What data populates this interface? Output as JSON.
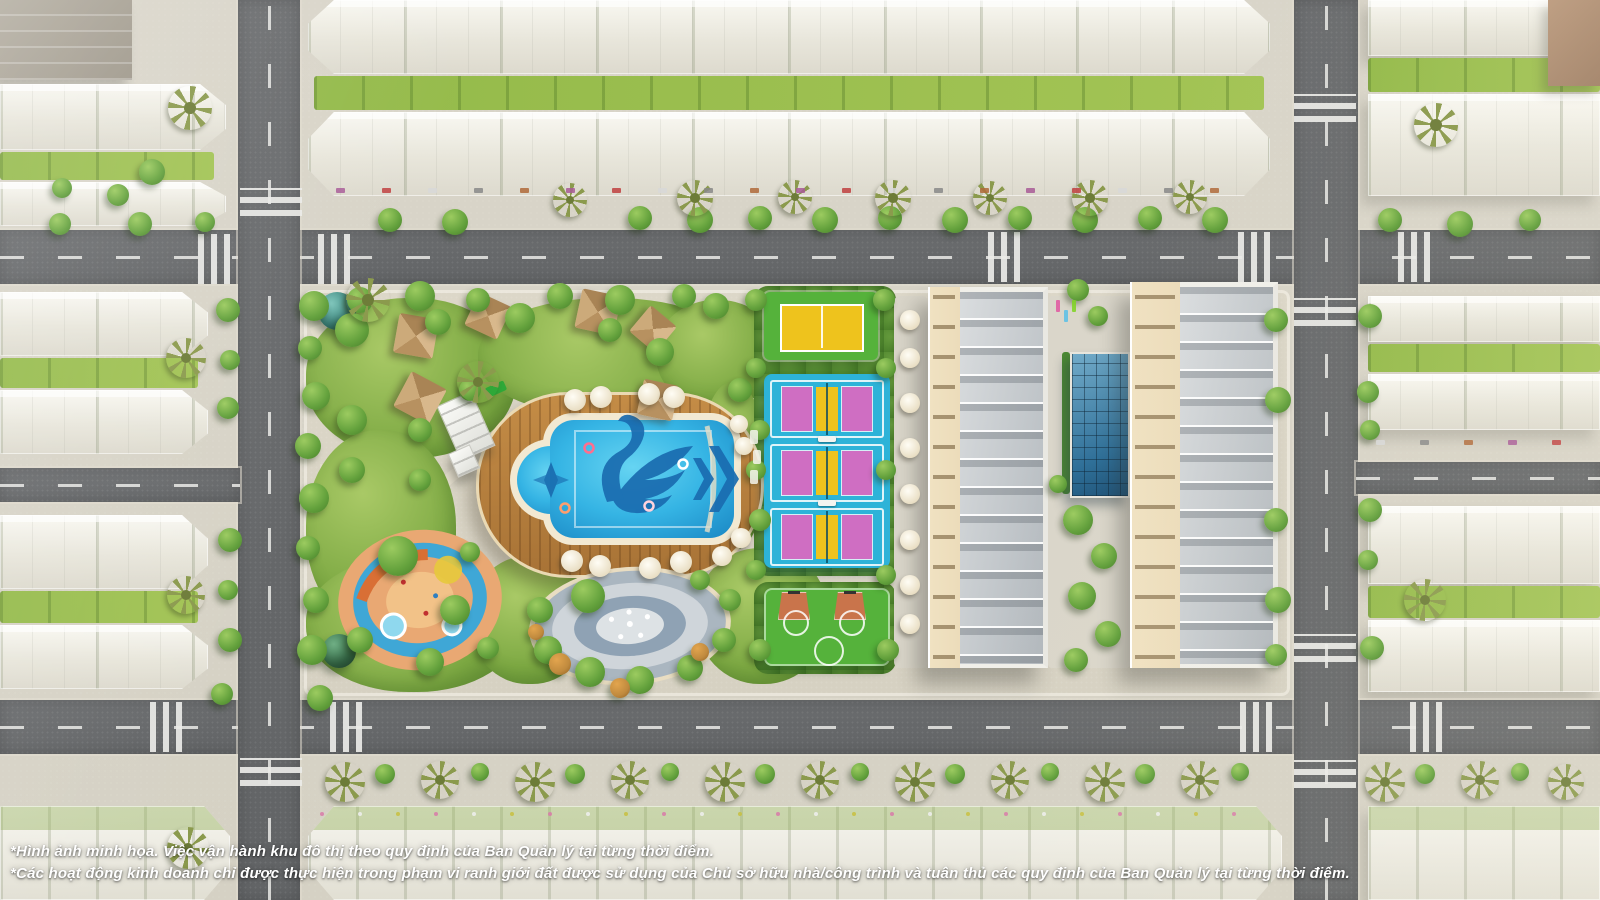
{
  "image": {
    "kind": "aerial-masterplan-render",
    "width": 1600,
    "height": 900
  },
  "footnotes": {
    "line1": "*Hình ảnh minh họa. Việc vận hành khu đô thị theo quy định của Ban Quản lý tại từng thời điểm.",
    "line2": "*Các hoạt động kinh doanh chỉ được thực hiện trong phạm vi ranh giới đất được sử dụng của Chủ sở hữu nhà/công trình và tuân thủ các quy định của Ban Quản lý tại từng thời điểm."
  },
  "palette": {
    "asphalt": "#6a6c6e",
    "sidewalk": "#d9d4c6",
    "lawn": "#94ba4a",
    "tree": "#63a13c",
    "treeDark": "#477f2a",
    "amberTree": "#c08a3e",
    "palm": "#8b9a4d",
    "poolWater": "#35b4e4",
    "poolDeep": "#1e8ec9",
    "poolMotif": "#1a6cb0",
    "poolTrim": "#f2e9d2",
    "deck": "#b8813f",
    "courtGreen": "#55b23b",
    "courtYellow": "#eec31d",
    "courtCyan": "#2db3d8",
    "courtMagenta": "#cf6ec2",
    "courtOrange": "#c9744b",
    "roof": "#c9cdd0",
    "wall": "#ecdcba",
    "glass": "#2d6e97",
    "bus": "#5ab42e",
    "carRed": "#c8272c",
    "carBlue": "#2d7fc1",
    "carYellow": "#ecc91f",
    "carWhite": "#f1f1ef",
    "carGray": "#8e9094",
    "domeTeal": "#3f8f85",
    "domeGreen": "#3e7a52",
    "gazebo": "#c9a87a",
    "plaza": "#9fb0bd",
    "text": "#ffffff"
  },
  "scene": {
    "features": [
      "central-amenity-park",
      "resort-pool-with-swan-mosaic",
      "wooden-pool-deck",
      "kids-water-playground",
      "event-plaza-with-fountain",
      "thatched-gazebos",
      "multi-sport-court",
      "pickleball-courts",
      "basketball-court",
      "glass-clubhouse",
      "shophouse-buildings",
      "ghosted-townhouse-rows",
      "street-grid-with-crosswalks",
      "green-buses",
      "street-trees-and-palms"
    ],
    "counts": {
      "pickleball_courts": 3,
      "buses": 4,
      "gazebos": 6
    }
  }
}
